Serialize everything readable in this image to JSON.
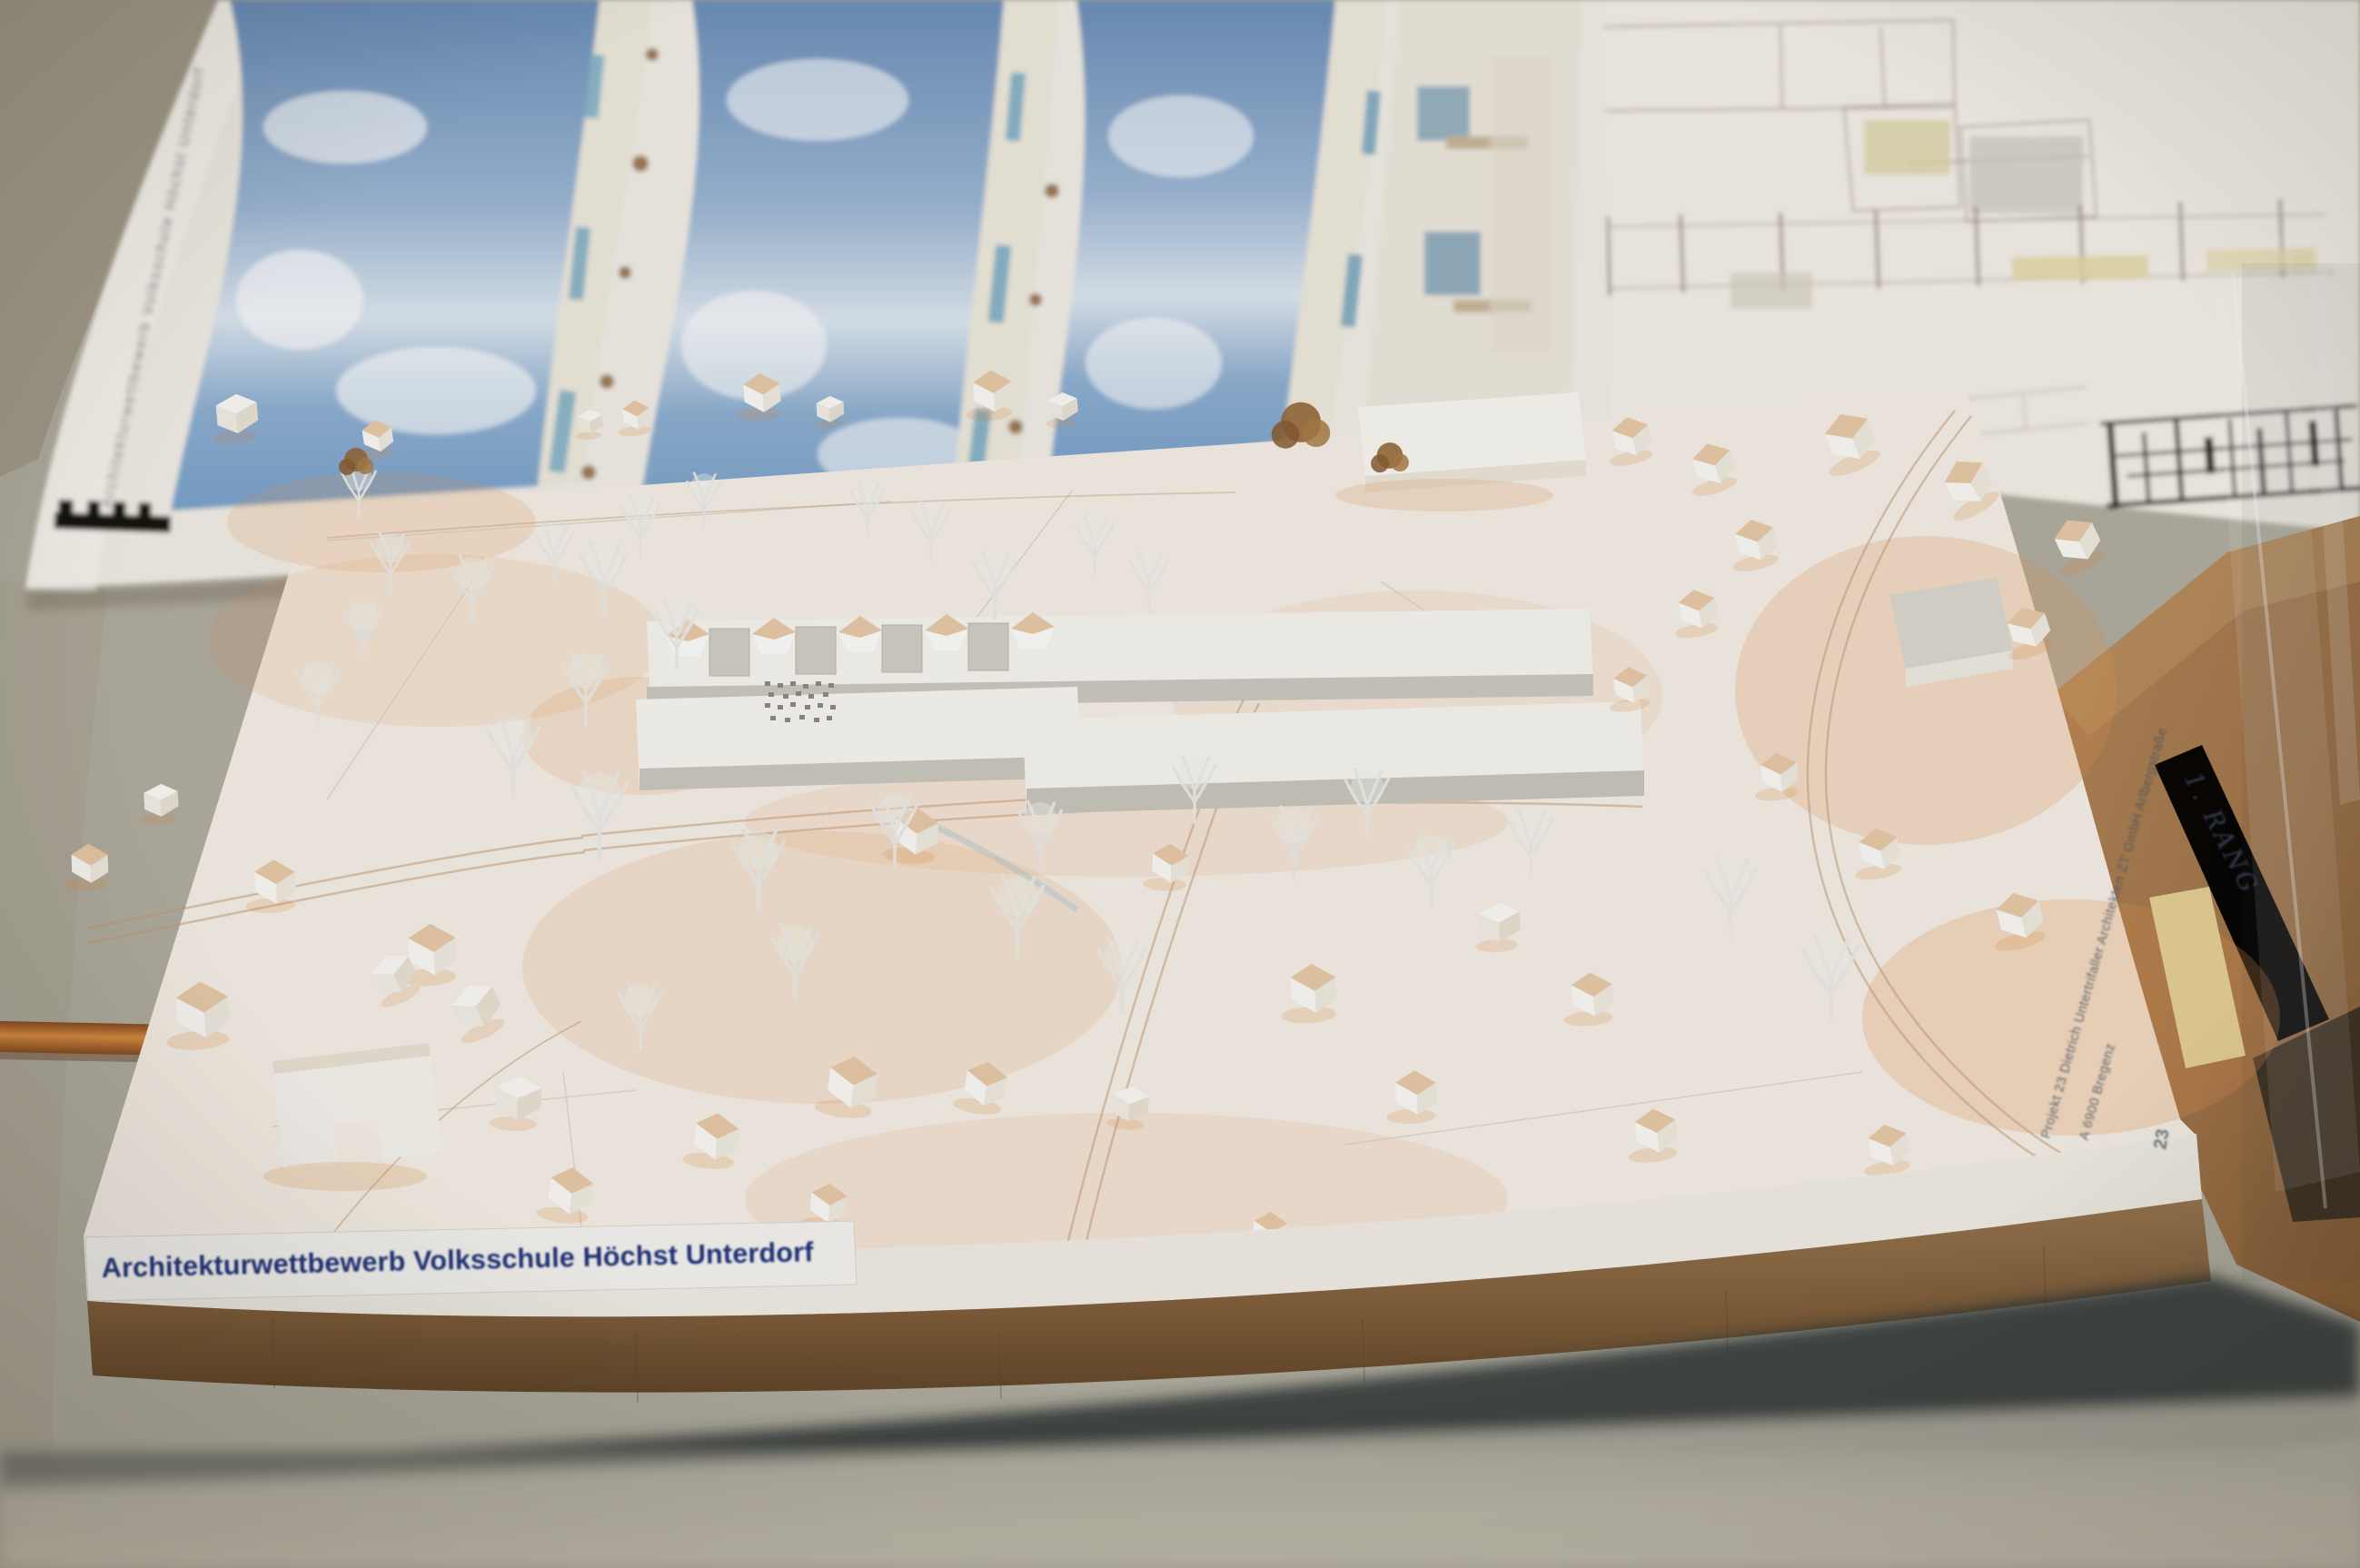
{
  "photo": {
    "subject": "Architectural competition site model on a table with plans behind",
    "model_board": {
      "label": "Architekturwettbewerb Volksschule Höchst Unterdorf",
      "credit_line1": "Projekt 23 Dietrich Untertrifaller Architekten ZT GmbH Arlbergstraße",
      "credit_line2": "A 6900 Bregenz",
      "entry_number": "23"
    },
    "poster": {
      "caption_vertical": "Architekturwettbewerb Volksschule Höchst Unterdorf"
    },
    "tape_note": {
      "text": "1. RANG"
    },
    "palette": {
      "table": "#b2aea0",
      "sky_render": "#7e9dc1",
      "board_white": "#f7f0e7",
      "label_blue": "#21357c",
      "wood_base": "#85613e",
      "copper_rod": "#b76c2e",
      "kraft_cardboard": "#a87c4f",
      "warm_shadow": "#e7954f"
    }
  }
}
